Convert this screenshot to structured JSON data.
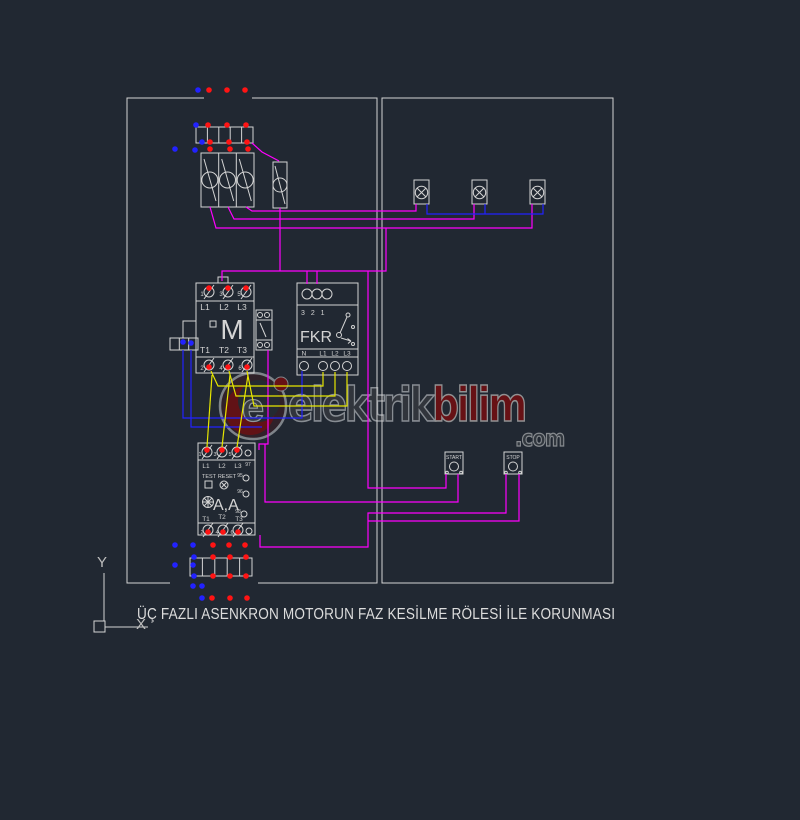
{
  "caption": "ÜÇ FAZLI ASENKRON MOTORUN FAZ KESİLME RÖLESİ İLE KORUNMASI",
  "axis": {
    "y": "Y",
    "x": "X"
  },
  "watermark": {
    "part1": "elektrik",
    "part2": "bilim",
    "tld": ".com",
    "monogram": "e"
  },
  "contactor": {
    "name": "M",
    "top_numbers": [
      "1",
      "3",
      "5"
    ],
    "phase_labels": [
      "L1",
      "L2",
      "L3"
    ],
    "load_labels": [
      "T1",
      "T2",
      "T3"
    ],
    "bottom_numbers": [
      "2",
      "4",
      "6"
    ]
  },
  "fkr": {
    "name": "FKR",
    "sequence": "3 2 1",
    "neutral_label": "N",
    "phase_labels": [
      "L1",
      "L2",
      "L3"
    ]
  },
  "overload": {
    "name": "A,A",
    "test_label": "TEST",
    "reset_label": "RESET",
    "top_numbers": [
      "1",
      "3",
      "5"
    ],
    "phase_labels": [
      "L1",
      "L2",
      "L3"
    ],
    "load_labels": [
      "T1",
      "T2",
      "T3"
    ],
    "bottom_numbers": [
      "2",
      "4",
      "6"
    ],
    "aux_numbers": [
      "97",
      "95",
      "96",
      "98"
    ]
  },
  "buttons": {
    "start": "START",
    "stop": "STOP"
  },
  "colors": {
    "background": "#212832",
    "line": "#d4d4d4",
    "magenta": "#ff00ff",
    "blue": "#2222ff",
    "yellow": "#e6e600",
    "red": "#ff1414"
  }
}
